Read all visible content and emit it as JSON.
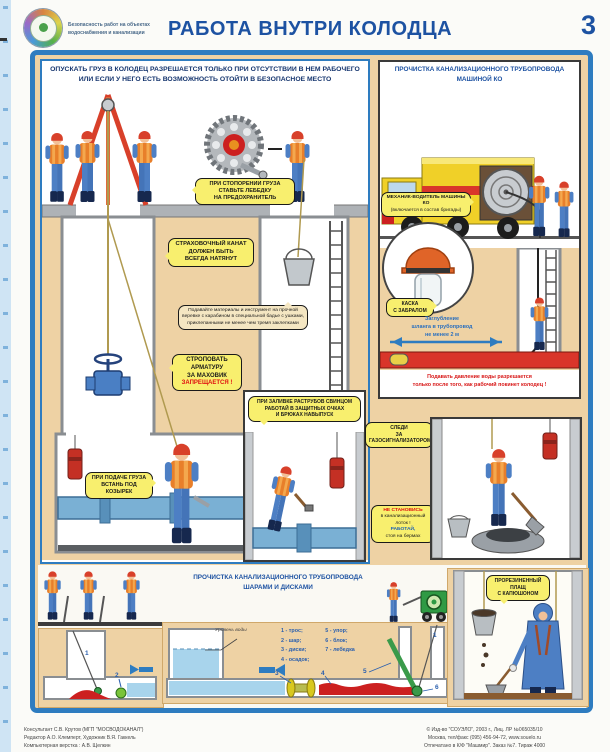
{
  "page": {
    "number": "3",
    "title": "РАБОТА ВНУТРИ КОЛОДЦА",
    "logo_caption_line1": "Безопасность работ на объектах",
    "logo_caption_line2": "водоснабжения и канализации"
  },
  "main_panel": {
    "warning_line1": "ОПУСКАТЬ ГРУЗ В КОЛОДЕЦ РАЗРЕШАЕТСЯ ТОЛЬКО ПРИ ОТСУТСТВИИ В НЕМ РАБОЧЕГО",
    "warning_line2": "ИЛИ ЕСЛИ У НЕГО ЕСТЬ ВОЗМОЖНОСТЬ ОТОЙТИ В БЕЗОПАСНОЕ МЕСТО",
    "callout_winch_line1": "ПРИ СТОПОРЕНИИ ГРУЗА",
    "callout_winch_line2": "СТАВЬТЕ ЛЕБЕДКУ",
    "callout_winch_line3": "НА ПРЕДОХРАНИТЕЛЬ",
    "callout_rope_line1": "СТРАХОВОЧНЫЙ КАНАТ",
    "callout_rope_line2": "ДОЛЖЕН БЫТЬ",
    "callout_rope_line3": "ВСЕГДА НАТЯНУТ",
    "callout_materials_line1": "Подавайте материалы и инструмент на прочной",
    "callout_materials_line2": "веревке с карабином в специальной бадье с ушками,",
    "callout_materials_line3": "приклепанными не менее чем тремя заклепками",
    "callout_sling_line1": "СТРОПОВАТЬ",
    "callout_sling_line2": "АРМАТУРУ",
    "callout_sling_line3": "ЗА МАХОВИК",
    "callout_sling_line4": "ЗАПРЕЩАЕТСЯ !",
    "callout_feed_line1": "ПРИ ПОДАЧЕ ГРУЗА",
    "callout_feed_line2": "ВСТАНЬ ПОД КОЗЫРЕК",
    "callout_lead_line1": "ПРИ ЗАЛИВКЕ РАСТРУБОВ СВИНЦОМ",
    "callout_lead_line2": "РАБОТАЙ В ЗАЩИТНЫХ ОЧКАХ",
    "callout_lead_line3": "И БРЮКАХ НАВЫПУСК"
  },
  "right_top": {
    "title_line1": "ПРОЧИСТКА КАНАЛИЗАЦИОННОГО ТРУБОПРОВОДА",
    "title_line2": "МАШИНОЙ КО",
    "mechanic_line1": "МЕХАНИК-ВОДИТЕЛЬ МАШИНЫ КО",
    "mechanic_line2": "(включается в состав бригады)",
    "helmet_line1": "КАСКА",
    "helmet_line2": "С ЗАБРАЛОМ",
    "depth_line1": "Заглубление",
    "depth_line2": "шланга в трубопровод",
    "depth_line3": "не менее 2 м",
    "pressure_line1": "Подавать давление воды разрешается",
    "pressure_line2": "только после того, как рабочий покинет колодец !"
  },
  "right_bottom": {
    "gas_line1": "СЛЕДИ",
    "gas_line2": "ЗА",
    "gas_line3": "ГАЗОСИГНАЛИЗАТОРОМ",
    "tray_line1": "НЕ СТАНОВИСЬ",
    "tray_line2": "в канализационный",
    "tray_line3": "лоток !",
    "tray_line4": "РАБОТАЙ,",
    "tray_line5": "стоя на бермах"
  },
  "bottom": {
    "title_line1": "ПРОЧИСТКА КАНАЛИЗАЦИОННОГО ТРУБОПРОВОДА",
    "title_line2": "ШАРАМИ И ДИСКАМИ",
    "water_level_label": "Уровень воды",
    "legend": [
      "1 - трос;",
      "2 - шар;",
      "3 - диски;",
      "4 - осадок;",
      "5 - упор;",
      "6 - блок;",
      "7 - лебедка"
    ],
    "labels": [
      "1",
      "2",
      "3",
      "4",
      "5",
      "6",
      "7"
    ],
    "raincoat_line1": "ПРОРЕЗИНЕННЫЙ",
    "raincoat_line2": "ПЛАЩ",
    "raincoat_line3": "С КАПЮШОНОМ"
  },
  "footer": {
    "left_line1": "Консультант С.В. Крутов (МГП \"МОСВОДОКАНАЛ\")",
    "left_line2": "Редактор А.О. Клемперт, Художник В.Я. Гаккель",
    "left_line3": "Компьютерная верстка : А.В. Щелкин",
    "right_line1": "© Изд-во \"СОУЭЛО\", 2003 г., Лиц. ЛР №065035/10",
    "right_line2": "Москва, тел/факс (095) 456-94-72, www.souelo.ru",
    "right_line3": "Отпечатано в К/Ф \"Машмир\". Заказ №7. Тираж 4000"
  },
  "colors": {
    "frame_blue": "#2e7cc0",
    "tan": "#eed2a4",
    "callout_yellow": "#f8ef6e",
    "title_blue": "#1d52a2",
    "warning_navy": "#15356e",
    "alert_red": "#e01010",
    "truck_yellow": "#f0d028",
    "vest_orange": "#e87f2a"
  }
}
